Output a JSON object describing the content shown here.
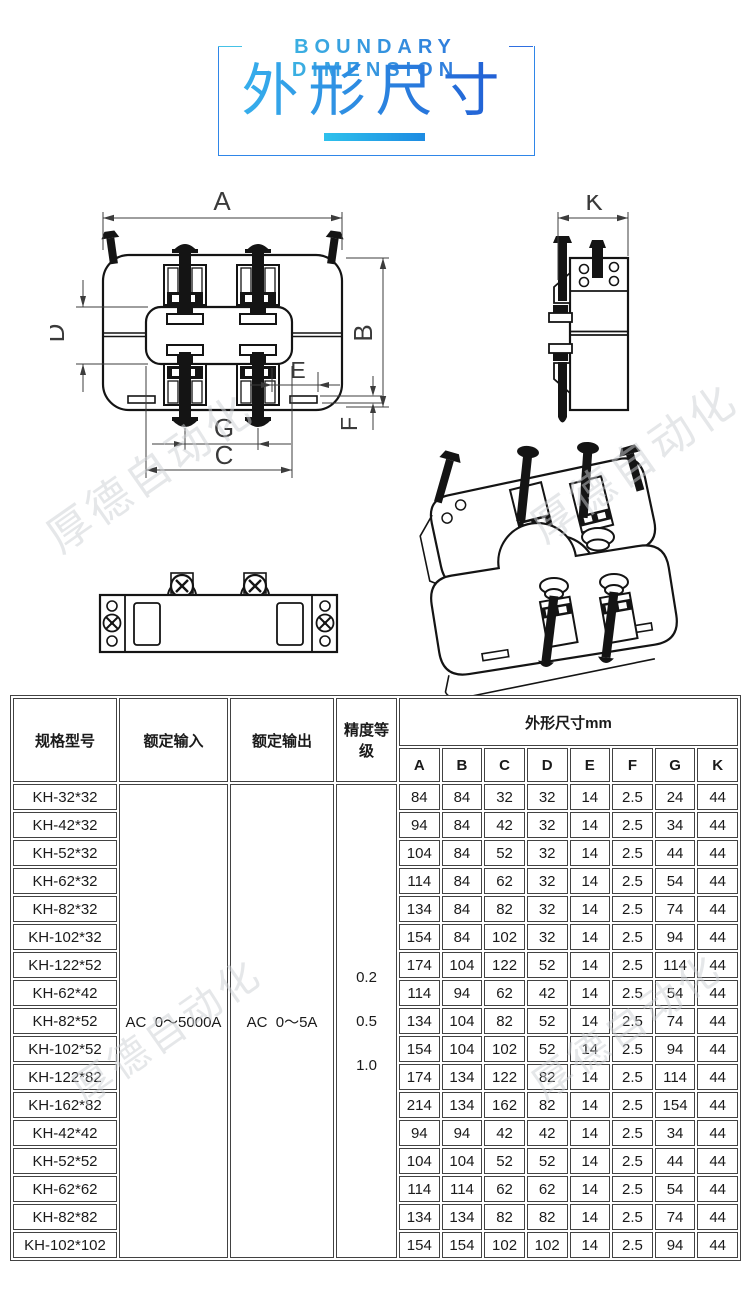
{
  "header": {
    "title_en": "BOUNDARY DIMENSION",
    "title_zh": "外形尺寸"
  },
  "watermark": {
    "text": "厚德自动化"
  },
  "drawings": {
    "labels": {
      "A": "A",
      "B": "B",
      "C": "C",
      "D": "D",
      "E": "E",
      "F": "F",
      "G": "G",
      "K": "K"
    }
  },
  "table": {
    "headers": {
      "model": "规格型号",
      "rated_input": "额定输入",
      "rated_output": "额定输出",
      "accuracy": "精度等级",
      "dimensions": "外形尺寸mm",
      "dim_cols": [
        "A",
        "B",
        "C",
        "D",
        "E",
        "F",
        "G",
        "K"
      ]
    },
    "rated_input_value": "AC  0～5000A",
    "rated_output_value": "AC  0～5A",
    "accuracy_values": [
      "0.2",
      "0.5",
      "1.0"
    ],
    "rows": [
      {
        "model": "KH-32*32",
        "dims": [
          84,
          84,
          32,
          32,
          14,
          2.5,
          24,
          44
        ]
      },
      {
        "model": "KH-42*32",
        "dims": [
          94,
          84,
          42,
          32,
          14,
          2.5,
          34,
          44
        ]
      },
      {
        "model": "KH-52*32",
        "dims": [
          104,
          84,
          52,
          32,
          14,
          2.5,
          44,
          44
        ]
      },
      {
        "model": "KH-62*32",
        "dims": [
          114,
          84,
          62,
          32,
          14,
          2.5,
          54,
          44
        ]
      },
      {
        "model": "KH-82*32",
        "dims": [
          134,
          84,
          82,
          32,
          14,
          2.5,
          74,
          44
        ]
      },
      {
        "model": "KH-102*32",
        "dims": [
          154,
          84,
          102,
          32,
          14,
          2.5,
          94,
          44
        ]
      },
      {
        "model": "KH-122*52",
        "dims": [
          174,
          104,
          122,
          52,
          14,
          2.5,
          114,
          44
        ]
      },
      {
        "model": "KH-62*42",
        "dims": [
          114,
          94,
          62,
          42,
          14,
          2.5,
          54,
          44
        ]
      },
      {
        "model": "KH-82*52",
        "dims": [
          134,
          104,
          82,
          52,
          14,
          2.5,
          74,
          44
        ]
      },
      {
        "model": "KH-102*52",
        "dims": [
          154,
          104,
          102,
          52,
          14,
          2.5,
          94,
          44
        ]
      },
      {
        "model": "KH-122*82",
        "dims": [
          174,
          134,
          122,
          82,
          14,
          2.5,
          114,
          44
        ]
      },
      {
        "model": "KH-162*82",
        "dims": [
          214,
          134,
          162,
          82,
          14,
          2.5,
          154,
          44
        ]
      },
      {
        "model": "KH-42*42",
        "dims": [
          94,
          94,
          42,
          42,
          14,
          2.5,
          34,
          44
        ]
      },
      {
        "model": "KH-52*52",
        "dims": [
          104,
          104,
          52,
          52,
          14,
          2.5,
          44,
          44
        ]
      },
      {
        "model": "KH-62*62",
        "dims": [
          114,
          114,
          62,
          62,
          14,
          2.5,
          54,
          44
        ]
      },
      {
        "model": "KH-82*82",
        "dims": [
          134,
          134,
          82,
          82,
          14,
          2.5,
          74,
          44
        ]
      },
      {
        "model": "KH-102*102",
        "dims": [
          154,
          154,
          102,
          102,
          14,
          2.5,
          94,
          44
        ]
      }
    ]
  }
}
